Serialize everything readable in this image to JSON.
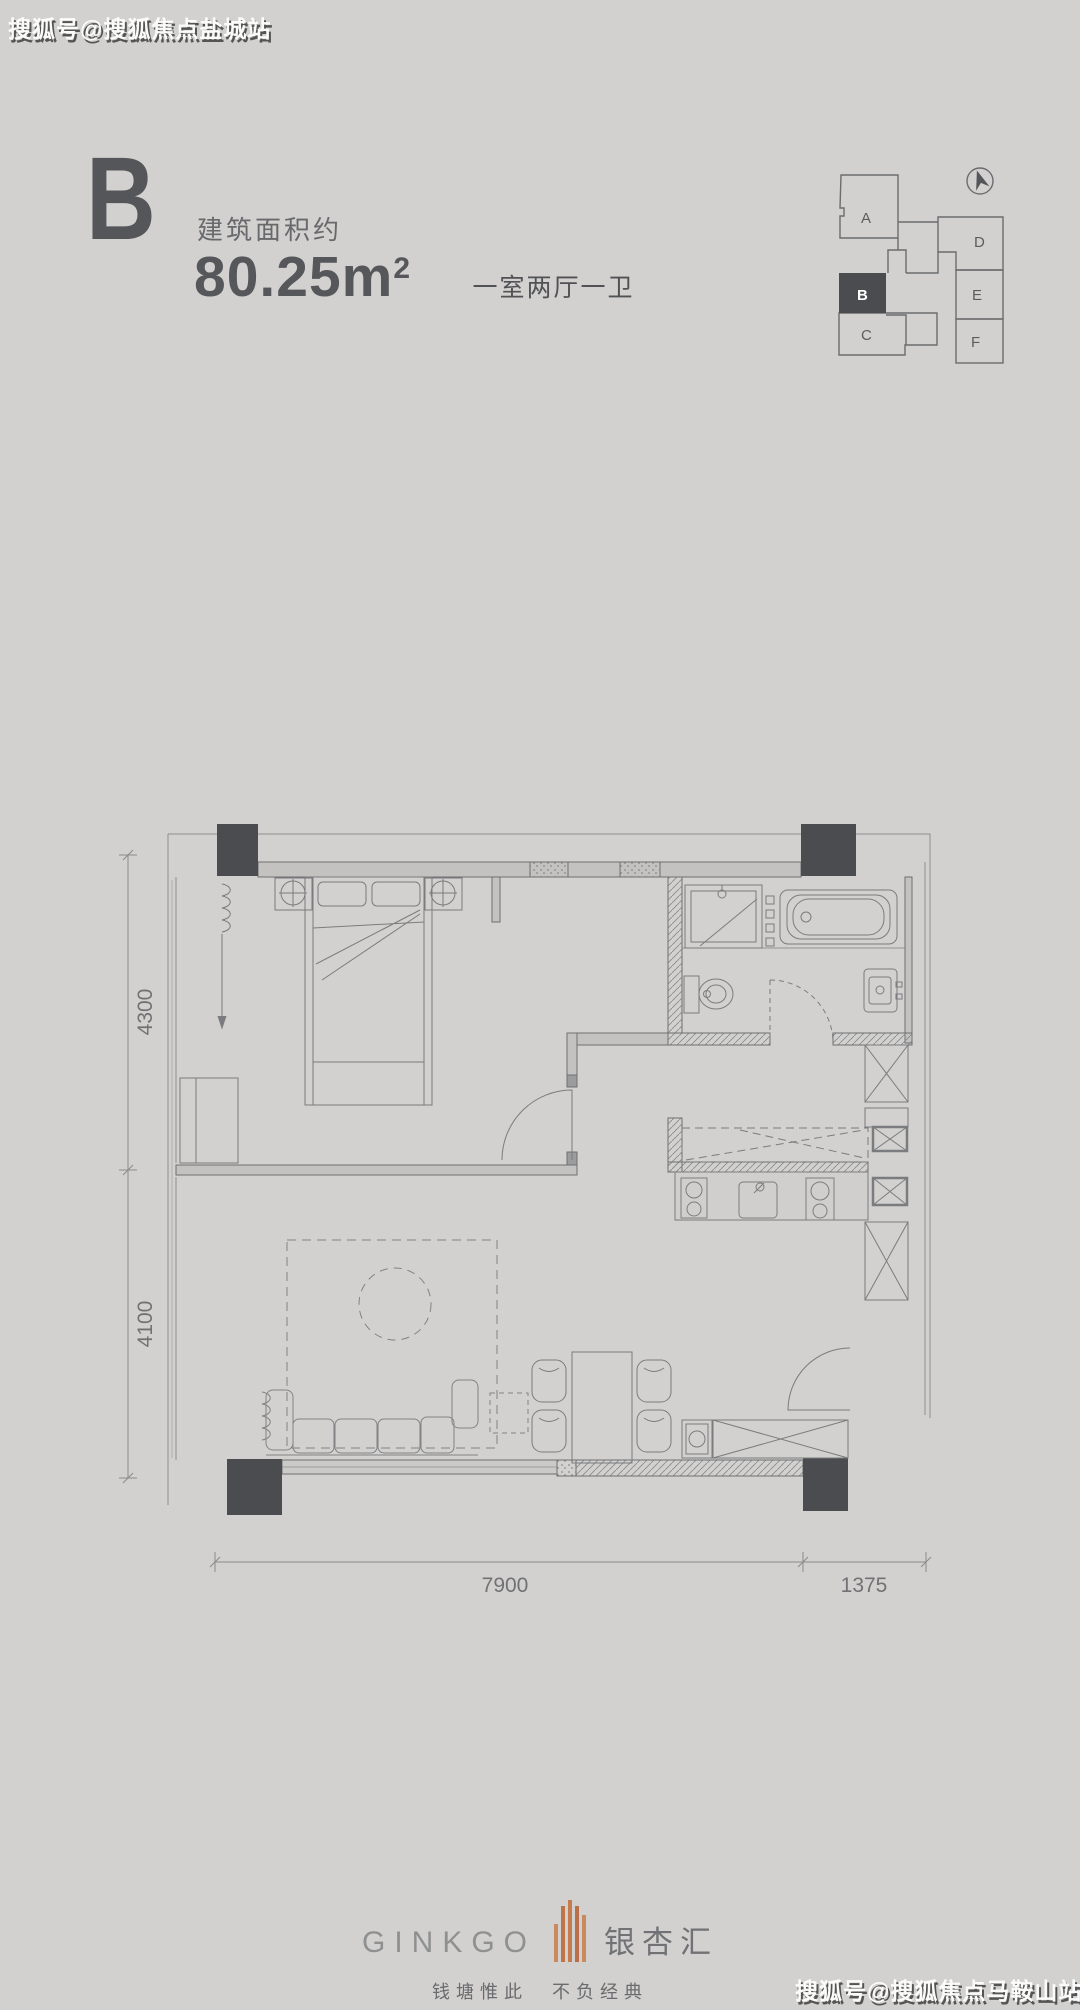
{
  "watermarks": {
    "top_left": "搜狐号@搜狐焦点盐城站",
    "bottom_right": "搜狐号@搜狐焦点马鞍山站"
  },
  "unit_header": {
    "letter": "B",
    "area_label": "建筑面积约",
    "area_value": "80.25m",
    "area_sup": "2",
    "rooms": "一室两厅一卫"
  },
  "key_plan": {
    "units": [
      {
        "label": "A",
        "highlighted": false
      },
      {
        "label": "B",
        "highlighted": true
      },
      {
        "label": "C",
        "highlighted": false
      },
      {
        "label": "D",
        "highlighted": false
      },
      {
        "label": "E",
        "highlighted": false
      },
      {
        "label": "F",
        "highlighted": false
      }
    ]
  },
  "floor_plan": {
    "dims": {
      "left_top": "4300",
      "left_bottom": "4100",
      "bottom_main": "7900",
      "bottom_right": "1375"
    }
  },
  "brand": {
    "name_en": "GINKGO",
    "name_cn": "银杏汇",
    "tagline": "钱塘惟此　不负经典"
  },
  "colors": {
    "background": "#d2d1cf",
    "ink": "#55565a",
    "column": "#4b4c4f",
    "accent_copper": "#c0784f"
  }
}
